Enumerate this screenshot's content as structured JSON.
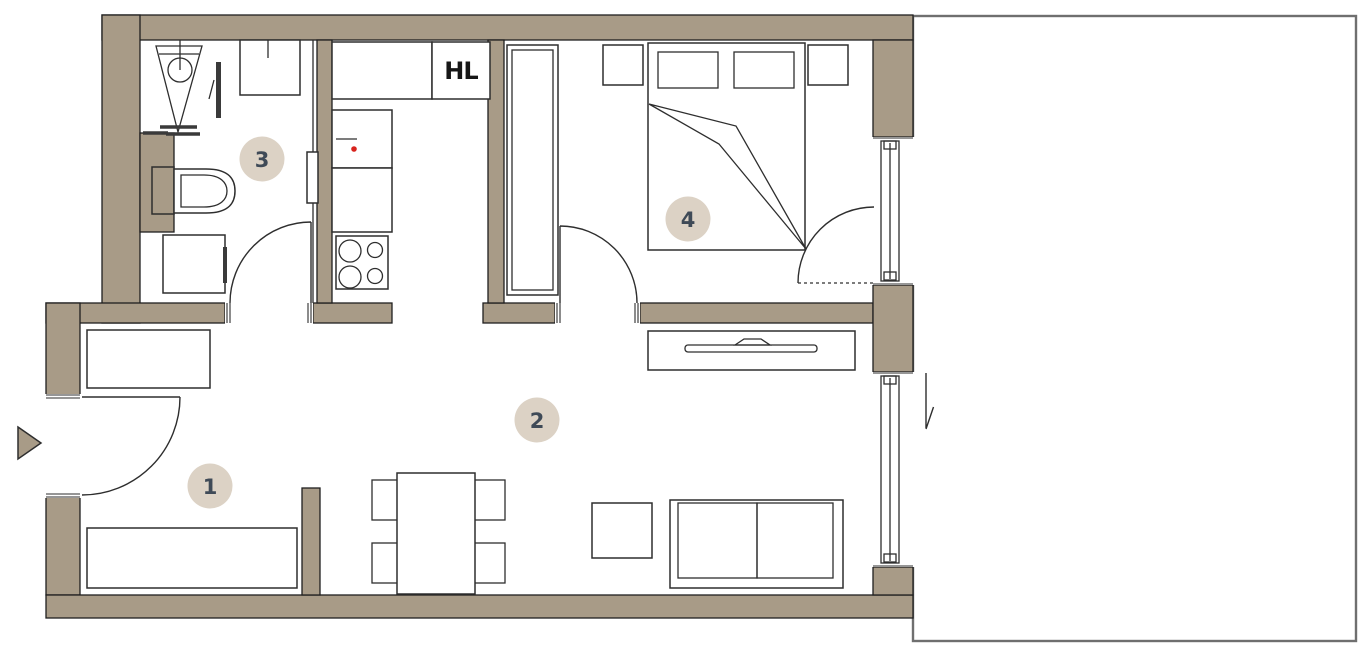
{
  "floorplan": {
    "shaft_label": "HL",
    "rooms": [
      {
        "label": "1"
      },
      {
        "label": "2"
      },
      {
        "label": "3"
      },
      {
        "label": "4"
      }
    ]
  },
  "colors": {
    "bg": "#ffffff",
    "wall": "#a89b87",
    "wall-stroke": "#1f1f1f",
    "line": "#2e2e2e",
    "badge": "#dcd2c5",
    "badge-text": "#3f4a57",
    "accent-red": "#d8231d",
    "balcony": "#6f6f6f",
    "text": "#161616"
  }
}
